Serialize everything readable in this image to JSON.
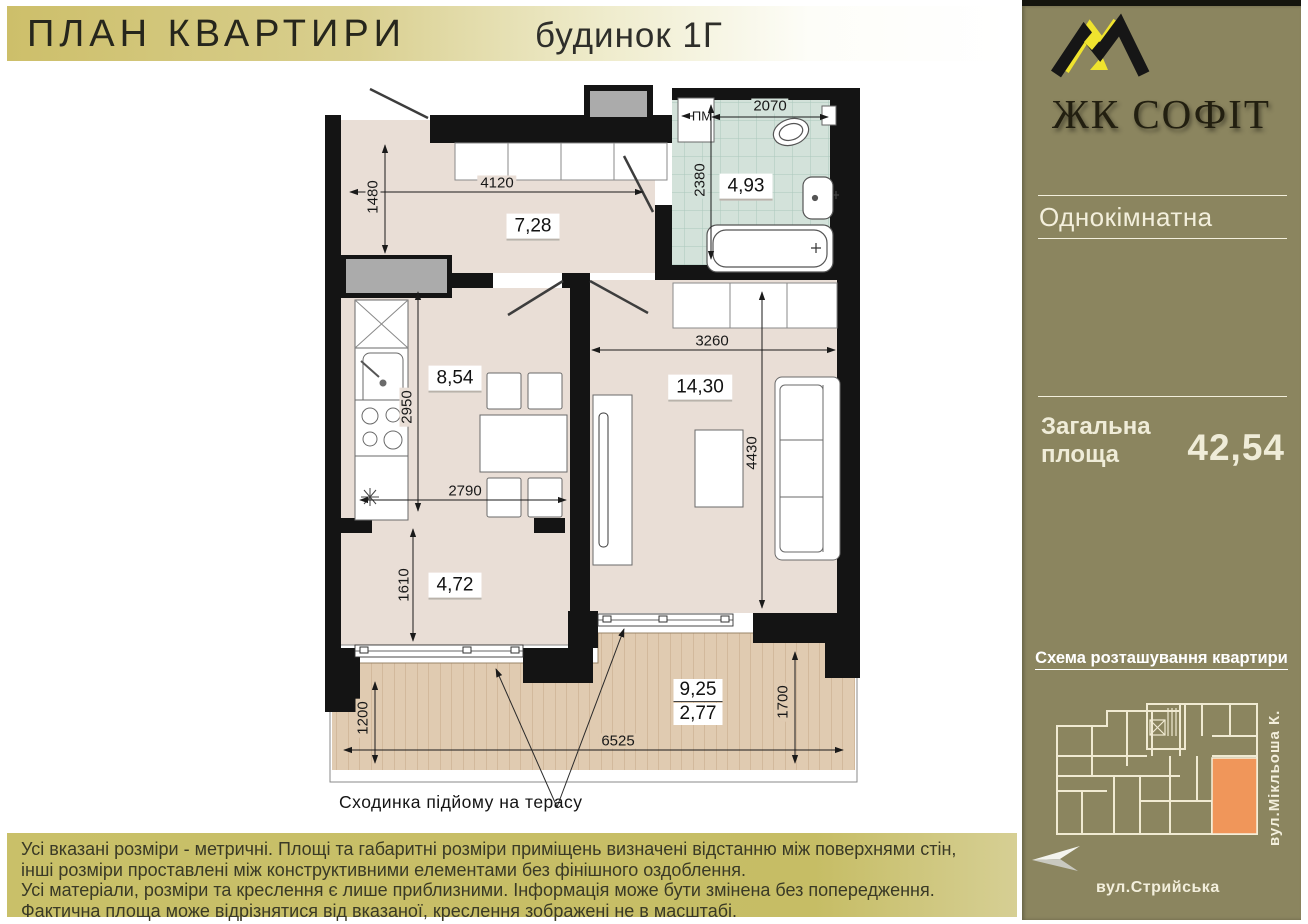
{
  "header": {
    "title": "ПЛАН КВАРТИРИ",
    "building": "будинок 1Г"
  },
  "sidebar": {
    "brand": "ЖК СОФІТ",
    "apartment_type": "Однокімнатна",
    "area_label_line1": "Загальна",
    "area_label_line2": "площа",
    "area_value": "42,54",
    "scheme_title": "Схема розташування квартири",
    "street_side": "вул.Мікльоша К.",
    "street_bottom": "вул.Стрийська"
  },
  "plan": {
    "annotation": "Сходинка підйому на терасу",
    "rooms": {
      "hallway": "7,28",
      "bathroom": "4,93",
      "kitchen": "8,54",
      "living": "14,30",
      "alcove": "4,72",
      "terrace_total": "9,25",
      "terrace_reduced": "2,77"
    },
    "dims": {
      "washer": "ПМ",
      "hall_height": "1480",
      "hall_width": "4120",
      "bath_width": "2070",
      "bath_height": "2380",
      "kitchen_height": "2950",
      "kitchen_width": "2790",
      "living_width": "3260",
      "living_height": "4430",
      "alcove_height": "1610",
      "terrace_left_height": "1200",
      "terrace_width": "6525",
      "terrace_right_height": "1700"
    }
  },
  "disclaimer": {
    "lines": [
      "Усі вказані розміри - метричні. Площі та габаритні розміри приміщень визначені відстанню між  поверхнями стін,",
      "інші розміри проставлені між конструктивними елементами без фінішного оздоблення.",
      "Усі матеріали, розміри та креслення є лише приблизними. Інформація може бути змінена без попередження.",
      "Фактична площа може відрізнятися від вказаної, креслення зображені не в масштабі."
    ]
  },
  "colors": {
    "sidebar_bg": "#8b855f",
    "header_gold": "#cdbf6a",
    "highlight_apartment": "#f0965a",
    "bathroom_tile": "#d3e2da",
    "floor": "#e9ded6",
    "deck": "#e0cbb1",
    "logo_yellow": "#efe32e"
  }
}
